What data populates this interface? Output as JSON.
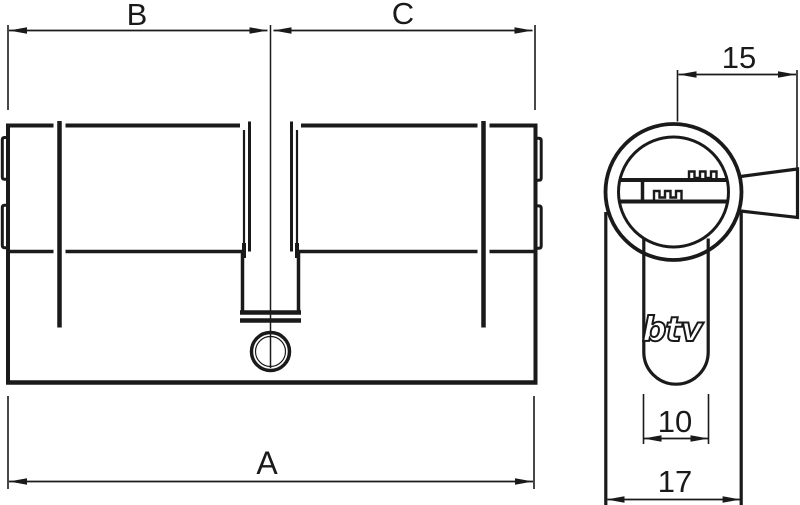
{
  "page": {
    "title": "Euro profile double cylinder dimensional drawing",
    "colors": {
      "ink": "#1a1a1a",
      "background": "#ffffff"
    }
  },
  "side_view": {
    "description": "cylinder side elevation",
    "dimensions": {
      "left_half": "B",
      "right_half": "C",
      "total_length": "A"
    }
  },
  "front_view": {
    "description": "cylinder front profile",
    "logo": "btv",
    "dimensions": {
      "key_projection": "15",
      "keyway_width": "10",
      "body_width": "17"
    }
  }
}
